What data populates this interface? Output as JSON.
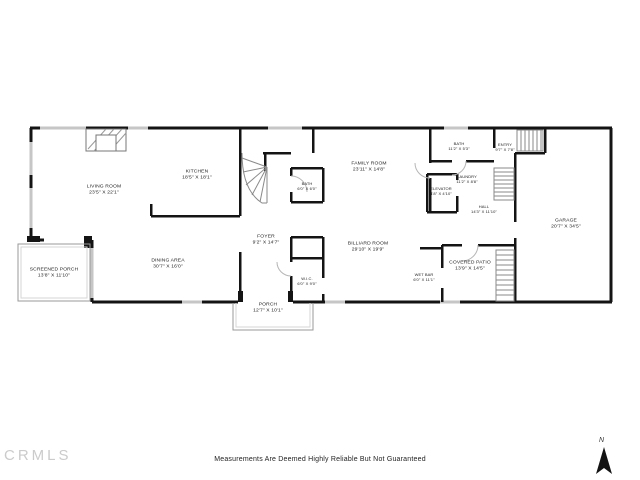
{
  "rooms": [
    {
      "id": "living-room",
      "name": "LIVING ROOM",
      "dims": "23'5\" X 22'1\""
    },
    {
      "id": "kitchen",
      "name": "KITCHEN",
      "dims": "18'5\" X 18'1\""
    },
    {
      "id": "bath-main",
      "name": "BATH",
      "dims": "6'0\" X 6'0\""
    },
    {
      "id": "family-room",
      "name": "FAMILY ROOM",
      "dims": "23'11\" X 14'8\""
    },
    {
      "id": "bath-upper",
      "name": "BATH",
      "dims": "11'2\" X 5'3\""
    },
    {
      "id": "entry",
      "name": "ENTRY",
      "dims": "9'7\" X 7'8\""
    },
    {
      "id": "laundry",
      "name": "LAUNDRY",
      "dims": "11'2\" X 8'8\""
    },
    {
      "id": "elevator",
      "name": "ELEVATOR",
      "dims": "4'8\" X 4'10\""
    },
    {
      "id": "hall",
      "name": "HALL",
      "dims": "14'3\" X 11'10\""
    },
    {
      "id": "garage",
      "name": "GARAGE",
      "dims": "20'7\" X 34'5\""
    },
    {
      "id": "foyer",
      "name": "FOYER",
      "dims": "9'2\" X 14'7\""
    },
    {
      "id": "billiard-room",
      "name": "BILLIARD ROOM",
      "dims": "29'10\" X 19'9\""
    },
    {
      "id": "wic",
      "name": "W.I.C.",
      "dims": "6'0\" X 9'0\""
    },
    {
      "id": "wet-bar",
      "name": "WET BAR",
      "dims": "6'0\" X 11'1\""
    },
    {
      "id": "covered-patio",
      "name": "COVERED PATIO",
      "dims": "13'9\" X 14'5\""
    },
    {
      "id": "dining-area",
      "name": "DINING AREA",
      "dims": "30'7\" X 16'0\""
    },
    {
      "id": "screened-porch",
      "name": "SCREENED PORCH",
      "dims": "13'8\" X 11'10\""
    },
    {
      "id": "porch",
      "name": "PORCH",
      "dims": "12'7\" X 10'1\""
    }
  ],
  "footer": {
    "disclaimer": "Measurements Are Deemed Highly Reliable But Not Guaranteed",
    "watermark": "CRMLS",
    "north_label": "N"
  },
  "colors": {
    "wall": "#141414",
    "window": "#c6c6c6",
    "stairs": "#8a8a8a",
    "watermark": "#cbcbcb"
  }
}
